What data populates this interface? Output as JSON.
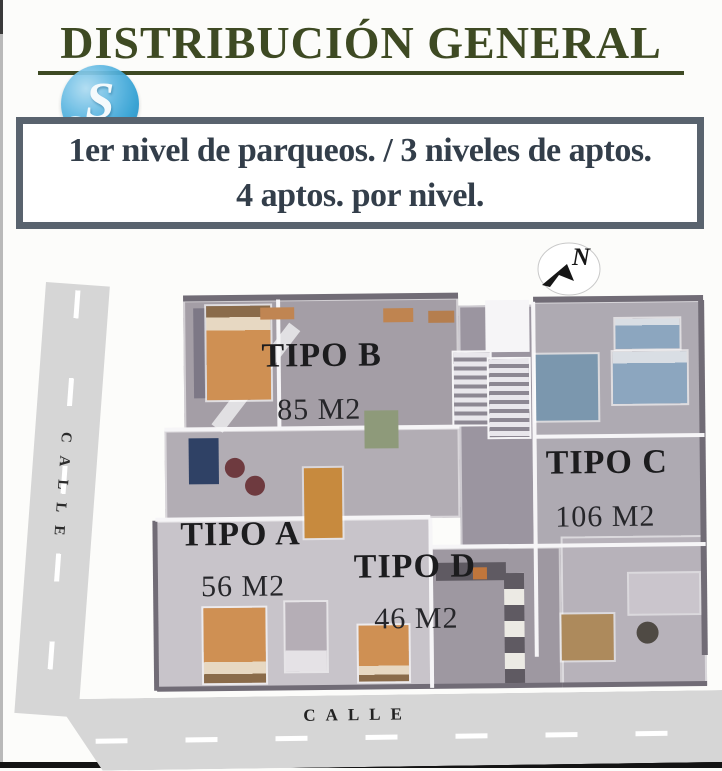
{
  "page": {
    "title_text": "DISTRIBUCIÓN GENERAL"
  },
  "logo": {
    "letter": "S"
  },
  "info_box": {
    "line1": "1er nivel de parqueos. / 3 niveles de aptos.",
    "line2": "4 aptos. por nivel."
  },
  "north_indicator": {
    "label": "N"
  },
  "units": [
    {
      "id": "tipo-b",
      "name": "TIPO B",
      "area": "85 M2"
    },
    {
      "id": "tipo-c",
      "name": "TIPO C",
      "area": "106 M2"
    },
    {
      "id": "tipo-a",
      "name": "TIPO A",
      "area": "56 M2"
    },
    {
      "id": "tipo-d",
      "name": "TIPO D",
      "area": "46 M2"
    }
  ],
  "streets": {
    "left_label": "CALLE",
    "bottom_label": "CALLE"
  },
  "colors": {
    "title_green": "#3e4a23",
    "box_border_slate": "#59636e",
    "box_text_slate": "#333e4a",
    "logo_blue": "#2d9ed2",
    "label_ink": "#1c1c1e",
    "road_gray": "#d6d6d6"
  }
}
